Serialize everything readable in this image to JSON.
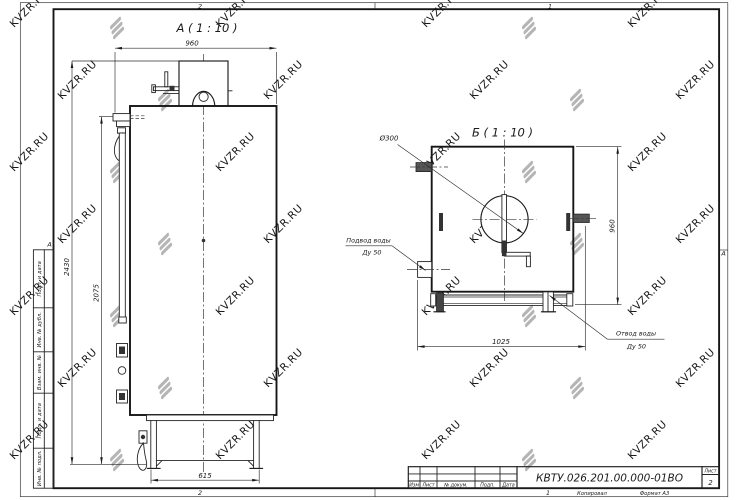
{
  "drawing": {
    "view_a": {
      "label": "А ( 1 : 10 )",
      "dim_width_top": "960",
      "dim_height_overall": "2430",
      "dim_height_body": "2075",
      "dim_base_width": "615"
    },
    "view_b": {
      "label": "Б ( 1 : 10 )",
      "dim_height": "960",
      "dim_width": "1025",
      "dim_flue": "Ø300",
      "inlet_label_line1": "Подвод воды",
      "inlet_label_line2": "Ду 50",
      "outlet_label_line1": "Отвод воды",
      "outlet_label_line2": "Ду 50"
    }
  },
  "frame": {
    "zone_top_left": "2",
    "zone_top_right": "1",
    "zone_bottom_left": "2",
    "zone_bottom_right": "1",
    "zone_left": "А",
    "zone_right": "А",
    "stamp_labels": [
      "Подп. и дата",
      "Инв. № дубл.",
      "Взам. инв. №",
      "Подп. и дата",
      "Инв. № подл."
    ]
  },
  "title_block": {
    "doc_number": "КВТУ.026.201.00.000-01ВО",
    "col_izm": "Изм",
    "col_list": "Лист",
    "col_doc": "№ докум.",
    "col_podp": "Подп.",
    "col_data": "Дата",
    "sheet_label": "Лист",
    "sheet_number": "2",
    "copied_label": "Копировал",
    "format_label": "Формат А3"
  },
  "watermark": {
    "text": "KVZR.RU",
    "text_color": "#c7c7c7",
    "logo_color": "#b5b5b5"
  }
}
